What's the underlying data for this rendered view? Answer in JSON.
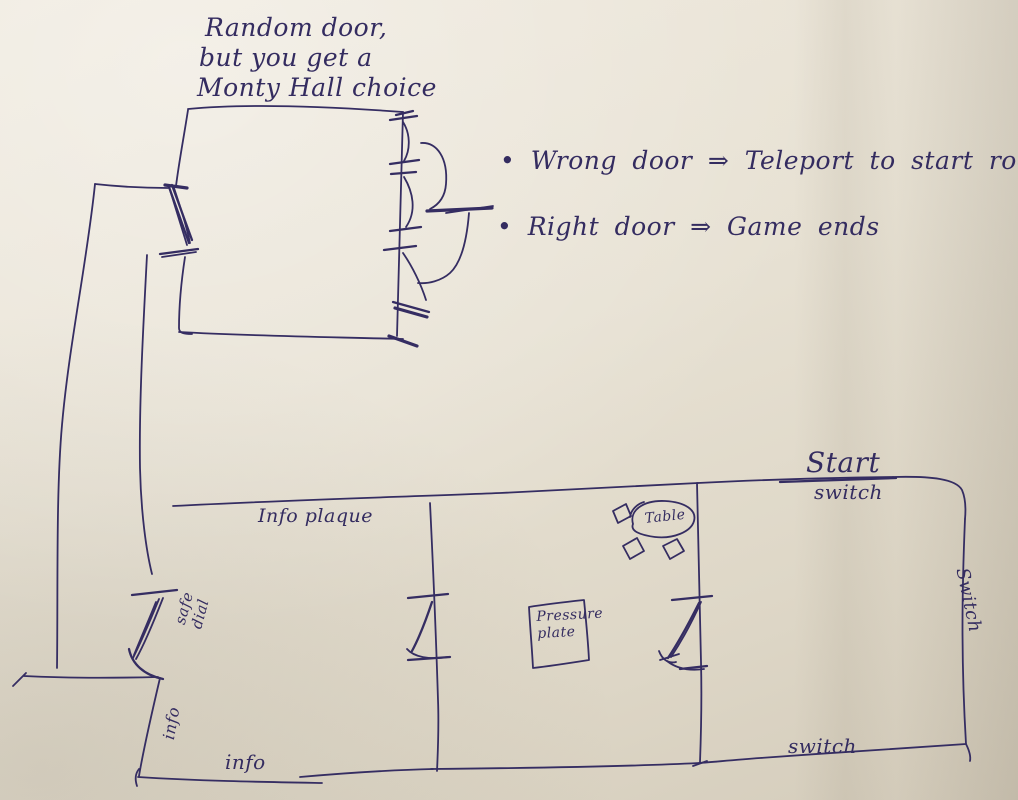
{
  "sketch": {
    "ink_color": "#352d62",
    "paper_color": "#e6dfd2",
    "description": "Hand-drawn game level map sketch"
  },
  "monty_room": {
    "note_lines": [
      "Random door,",
      "but you get a",
      "Monty Hall choice"
    ]
  },
  "rules": {
    "items": [
      {
        "bullet": "•",
        "text": "Wrong door ⇒ Teleport to start room"
      },
      {
        "bullet": "•",
        "text": "Right door ⇒ Game ends"
      }
    ]
  },
  "start_room": {
    "title": "Start",
    "subtitle": "switch",
    "right_wall_label": "Switch",
    "bottom_label": "switch"
  },
  "left_room": {
    "top_label": "Info plaque",
    "safe_dial_lines": [
      "safe",
      "dial"
    ],
    "wall_label": "info",
    "bottom_label": "info"
  },
  "middle_room": {
    "pressure_plate_lines": [
      "Pressure",
      "plate"
    ],
    "table_label": "Table"
  }
}
